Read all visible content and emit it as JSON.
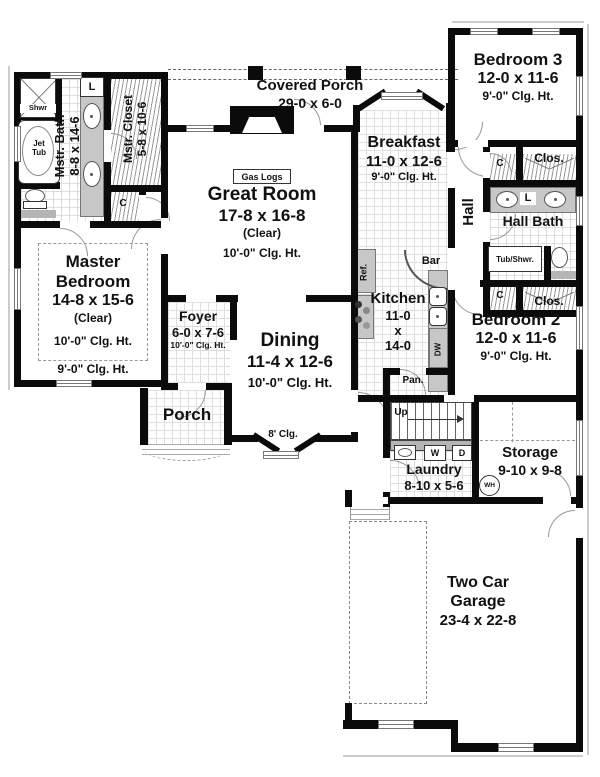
{
  "rooms": {
    "covered_porch": {
      "name": "Covered Porch",
      "dims": "29-0 x 6-0"
    },
    "great_room": {
      "name": "Great Room",
      "dims": "17-8 x 16-8",
      "clear": "(Clear)",
      "clg": "10'-0\" Clg. Ht."
    },
    "master_bedroom": {
      "name": "Master Bedroom",
      "dims": "14-8 x 15-6",
      "clear": "(Clear)",
      "clg": "10'-0\" Clg. Ht.",
      "clg_outer": "9'-0\" Clg. Ht."
    },
    "mstr_bath": {
      "name": "Mstr. Bath",
      "dims": "8-8 x 14-6"
    },
    "mstr_closet": {
      "name": "Mstr. Closet",
      "dims": "5-8 x 10-6"
    },
    "breakfast": {
      "name": "Breakfast",
      "dims": "11-0 x 12-6",
      "clg": "9'-0\" Clg. Ht."
    },
    "kitchen": {
      "name": "Kitchen",
      "dim_w": "11-0",
      "dim_sep": "x",
      "dim_l": "14-0"
    },
    "dining": {
      "name": "Dining",
      "dims": "11-4 x 12-6",
      "clg": "10'-0\" Clg. Ht.",
      "bay_clg": "8' Clg."
    },
    "foyer": {
      "name": "Foyer",
      "dims": "6-0 x 7-6",
      "clg": "10'-0\" Clg. Ht."
    },
    "porch": {
      "name": "Porch"
    },
    "bedroom2": {
      "name": "Bedroom 2",
      "dims": "12-0 x 11-6",
      "clg": "9'-0\" Clg. Ht."
    },
    "bedroom3": {
      "name": "Bedroom 3",
      "dims": "12-0 x 11-6",
      "clg": "9'-0\" Clg. Ht."
    },
    "hall": {
      "name": "Hall"
    },
    "hall_bath": {
      "name": "Hall Bath"
    },
    "laundry": {
      "name": "Laundry",
      "dims": "8-10 x 5-6"
    },
    "storage": {
      "name": "Storage",
      "dims": "9-10 x 9-8"
    },
    "garage": {
      "name": "Two Car Garage",
      "dims": "23-4 x 22-8"
    }
  },
  "fixtures": {
    "shower": "Shwr",
    "jet_tub_1": "Jet",
    "jet_tub_2": "Tub",
    "linen": "L",
    "closet_small": "C",
    "closet": "Clos.",
    "gas_logs": "Gas Logs",
    "refrigerator": "Ref.",
    "bar": "Bar",
    "dishwasher": "DW",
    "pantry": "Pan.",
    "stairs_up": "Up",
    "washer": "W",
    "dryer": "D",
    "water_heater": "WH",
    "tub_shower": "Tub/Shwr."
  },
  "colors": {
    "wall": "#0b0b0b",
    "counter": "#c7c7c7",
    "tile_line": "#dedede"
  }
}
